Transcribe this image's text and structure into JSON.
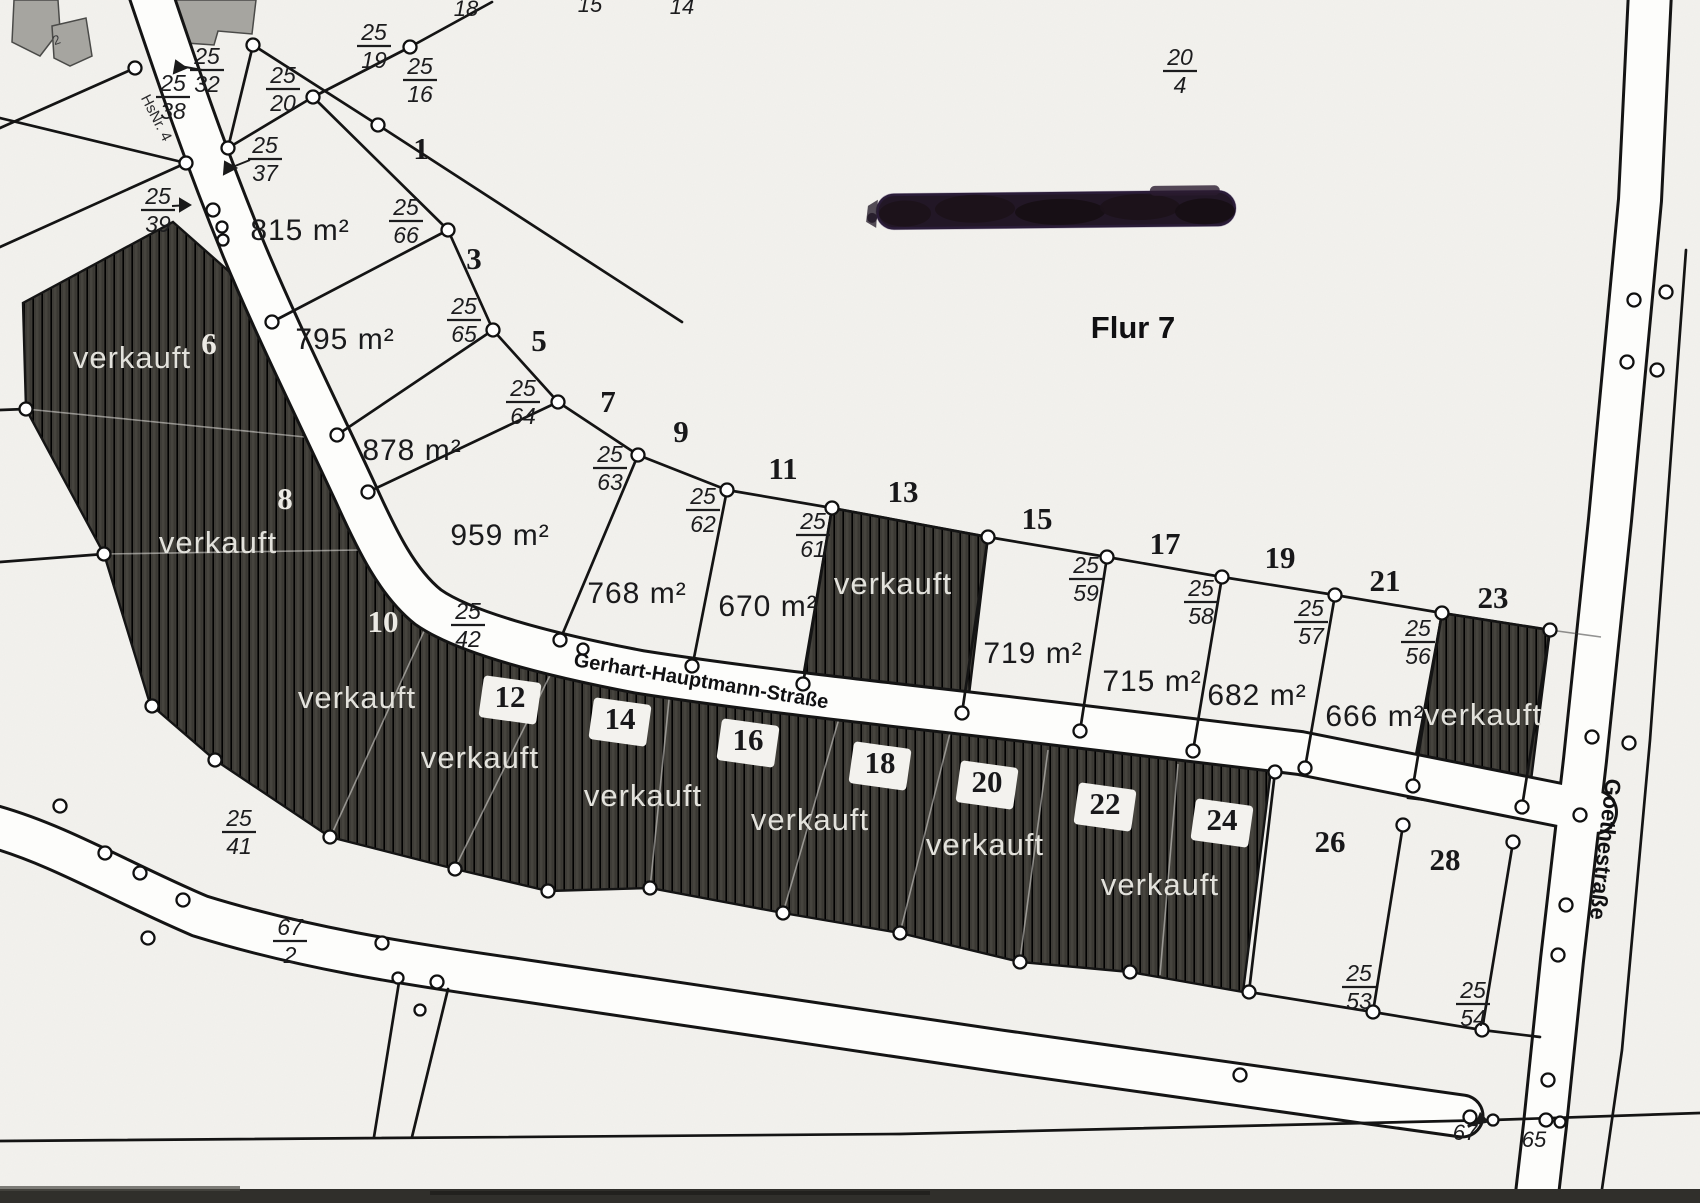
{
  "map": {
    "flur_label": "Flur 7",
    "street_main": "Gerhart-Hauptmann-Straße",
    "street_right": "Goethestraße",
    "house_ref": "HsNr. 4",
    "sold_text": "verkauft",
    "small_building_no": "2",
    "bottom_left_no": "67",
    "bottom_right_no": "65",
    "top_edge_numbers": [
      "18",
      "15",
      "14"
    ]
  },
  "colors": {
    "paper": "#f3f2ee",
    "street_white": "#fdfdfb",
    "parcel_dark": "#3e3c37",
    "ink": "#141414",
    "sold_text_color": "#e3e2dc",
    "redaction": "#221726"
  },
  "plots": {
    "p1": {
      "no": "1",
      "area": "815 m²"
    },
    "p3": {
      "no": "3",
      "area": "795 m²"
    },
    "p5": {
      "no": "5",
      "area": "878 m²"
    },
    "p7": {
      "no": "7",
      "area": "959 m²"
    },
    "p9": {
      "no": "9",
      "area": "768 m²"
    },
    "p11": {
      "no": "11",
      "area": "670 m²"
    },
    "p13": {
      "no": "13",
      "status": "verkauft"
    },
    "p15": {
      "no": "15",
      "area": "719 m²"
    },
    "p17": {
      "no": "17",
      "area": "715 m²"
    },
    "p19": {
      "no": "19",
      "area": "682 m²"
    },
    "p21": {
      "no": "21",
      "area": "666 m²"
    },
    "p23": {
      "no": "23",
      "status": "verkauft"
    },
    "p6": {
      "no": "6",
      "status": "verkauft"
    },
    "p8": {
      "no": "8",
      "status": "verkauft"
    },
    "p10": {
      "no": "10",
      "status": "verkauft"
    },
    "p12": {
      "no": "12",
      "status": "verkauft"
    },
    "p14": {
      "no": "14",
      "status": "verkauft"
    },
    "p16": {
      "no": "16",
      "status": "verkauft"
    },
    "p18": {
      "no": "18"
    },
    "p20": {
      "no": "20",
      "status": "verkauft"
    },
    "p22": {
      "no": "22"
    },
    "p24": {
      "no": "24",
      "status": "verkauft"
    },
    "p26": {
      "no": "26"
    },
    "p28": {
      "no": "28"
    }
  },
  "fractions": {
    "f25_32": {
      "top": "25",
      "bot": "32"
    },
    "f25_38": {
      "top": "25",
      "bot": "38"
    },
    "f25_20": {
      "top": "25",
      "bot": "20"
    },
    "f25_19": {
      "top": "25",
      "bot": "19"
    },
    "f25_16": {
      "top": "25",
      "bot": "16"
    },
    "f25_37": {
      "top": "25",
      "bot": "37"
    },
    "f25_39": {
      "top": "25",
      "bot": "39"
    },
    "f25_66": {
      "top": "25",
      "bot": "66"
    },
    "f25_65": {
      "top": "25",
      "bot": "65"
    },
    "f25_64": {
      "top": "25",
      "bot": "64"
    },
    "f25_63": {
      "top": "25",
      "bot": "63"
    },
    "f25_62": {
      "top": "25",
      "bot": "62"
    },
    "f25_61": {
      "top": "25",
      "bot": "61"
    },
    "f25_59": {
      "top": "25",
      "bot": "59"
    },
    "f25_58": {
      "top": "25",
      "bot": "58"
    },
    "f25_57": {
      "top": "25",
      "bot": "57"
    },
    "f25_56": {
      "top": "25",
      "bot": "56"
    },
    "f25_42": {
      "top": "25",
      "bot": "42"
    },
    "f25_41": {
      "top": "25",
      "bot": "41"
    },
    "f67_2": {
      "top": "67",
      "bot": "2"
    },
    "f20_4": {
      "top": "20",
      "bot": "4"
    },
    "f25_53": {
      "top": "25",
      "bot": "53"
    },
    "f25_54": {
      "top": "25",
      "bot": "54"
    }
  }
}
